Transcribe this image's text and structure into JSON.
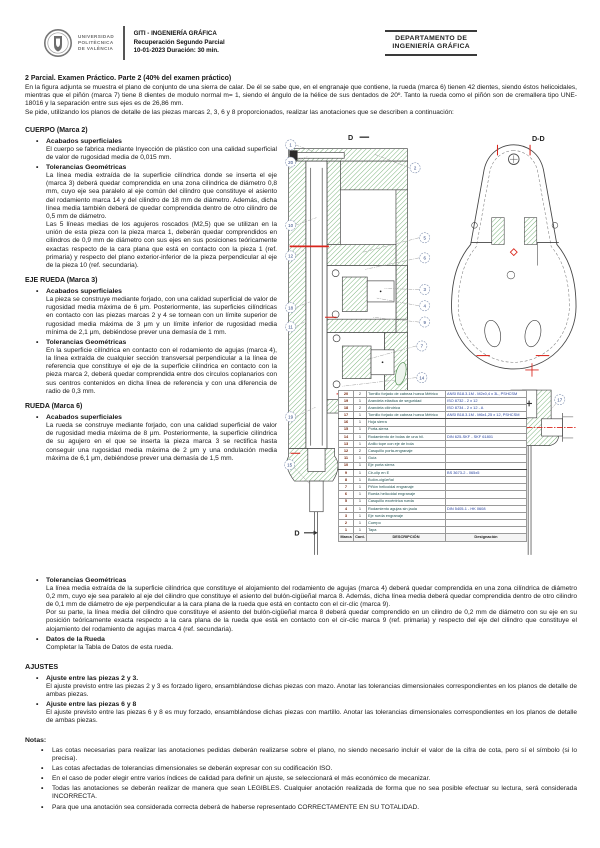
{
  "header": {
    "university_lines": [
      "UNIVERSIDAD",
      "POLITÈCNICA",
      "DE VALÈNCIA"
    ],
    "course_line1": "GITI - INGENIERÍA GRÁFICA",
    "course_line2": "Recuperación Segundo Parcial",
    "course_line3": "10-01-2023   Duración: 30 min.",
    "department_line1": "DEPARTAMENTO DE",
    "department_line2": "INGENIERÍA GRÁFICA"
  },
  "title": "2 Parcial. Examen Práctico. Parte 2 (40% del examen práctico)",
  "intro_p1": "En la figura adjunta se muestra el plano de conjunto de una sierra de calar. De él se sabe que, en el engranaje que contiene, la rueda (marca 6) tienen 42 dientes, siendo éstos helicoidales, mientras que el piñón (marca 7) tiene 8 dientes de modulo normal m= 1, siendo el ángulo de la hélice de sus dentados de 20º. Tanto la rueda como el piñón son de cremallera tipo UNE-18016 y la separación entre sus ejes es de 26,86 mm.",
  "intro_p2": "Se pide, utilizando los planos de detalle de las piezas marcas 2, 3, 6 y 8 proporcionados, realizar las anotaciones que se describen a continuación:",
  "sections": {
    "cuerpo": {
      "heading": "CUERPO (Marca 2)",
      "b1": {
        "title": "Acabados superficiales",
        "body": "El cuerpo se fabrica mediante Inyección de plástico con una calidad superficial de valor de rugosidad media de 0,015 mm."
      },
      "b2": {
        "title": "Tolerancias Geométricas",
        "body": "La línea media extraída de la superficie cilíndrica donde se inserta el eje (marca 3) deberá quedar comprendida en una zona cilíndrica de diámetro 0,8 mm, cuyo eje sea paralelo al eje común del cilindro que constituye el asiento del rodamiento marca 14 y del cilindro de 18 mm de diámetro. Además, dicha línea media también deberá de quedar comprendida dentro de otro cilindro de 0,5 mm de diámetro.",
        "body2": "Las 5 líneas medias de los agujeros roscados (M2,5) que se utilizan en la unión de esta pieza con la pieza marca 1, deberán quedar comprendidos en cilindros de 0,9 mm de diámetro con sus ejes en sus posiciones teóricamente exactas respecto de la cara plana que está en contacto con la pieza 1 (ref. primaria) y respecto del plano exterior-inferior de la pieza perpendicular al eje de la pieza 10 (ref. secundaria)."
      }
    },
    "eje": {
      "heading": "EJE RUEDA (Marca 3)",
      "b1": {
        "title": "Acabados superficiales",
        "body": "La pieza se construye mediante forjado, con una calidad superficial de valor de rugosidad media máxima de 6 μm. Posteriormente, las superficies cilíndricas en contacto con las piezas marcas 2 y 4 se tornean con un límite superior de rugosidad media máxima de 3 μm y un límite inferior de rugosidad media mínima de 2,1 μm, debiéndose prever una demasía de 1 mm."
      },
      "b2": {
        "title": "Tolerancias Geométricas",
        "body": "En la superficie cilíndrica en contacto con el rodamiento de agujas (marca 4), la línea extraída de cualquier sección transversal perpendicular a la línea de referencia que constituye el eje de la superficie cilíndrica en contacto con la pieza marca 2, deberá quedar comprendida entre dos círculos coplanarios con sus centros contenidos en dicha línea de referencia y con una diferencia de radio de 0,3 mm."
      }
    },
    "rueda": {
      "heading": "RUEDA (Marca 6)",
      "b1": {
        "title": "Acabados superficiales",
        "body": "La rueda se construye mediante forjado, con una calidad superficial de valor de rugosidad media máxima de 8 μm. Posteriormente, la superficie cilíndrica de su agujero en el que se inserta la pieza marca 3 se rectifica hasta conseguir una rugosidad media máxima de 2 μm y una ondulación media máxima de 6,1 μm, debiéndose prever una demasía de 1,5 mm."
      },
      "b2": {
        "title": "Tolerancias Geométricas",
        "body": "La línea media extraída de la superficie cilíndrica que constituye el alojamiento del rodamiento de agujas (marca 4) deberá quedar comprendida en una zona cilíndrica de diámetro 0,2 mm, cuyo eje sea paralelo al eje del cilindro que constituye el asiento del bulón-cigüeñal marca 8. Además, dicha línea media deberá quedar comprendida dentro de otro cilindro de 0,1 mm de diámetro de eje perpendicular a la cara plana de la rueda que está en contacto con el cir-clic (marca 9).",
        "body2": "Por su parte, la línea media del cilindro que constituye el asiento del bulón-cigüeñal marca 8 deberá quedar comprendido en un cilindro de 0,2 mm de diámetro con su eje en su posición teóricamente exacta respecto a la cara plana de la rueda que está en contacto con el cir-clic marca 9 (ref. primaria) y respecto del eje del cilindro que constituye el alojamiento del rodamiento de agujas marca 4 (ref. secundaria)."
      },
      "b3": {
        "title": "Datos de la Rueda",
        "body": "Completar la Tabla de Datos de esta rueda."
      }
    }
  },
  "ajustes": {
    "heading": "AJUSTES",
    "a1": {
      "title": "Ajuste entre las piezas 2 y 3.",
      "body": "El ajuste previsto entre las piezas 2 y 3 es forzado ligero, ensamblándose dichas piezas con mazo. Anotar las tolerancias dimensionales correspondientes en los planos de detalle de ambas piezas."
    },
    "a2": {
      "title": "Ajuste entre las piezas 6 y 8",
      "body": "El ajuste previsto entre las piezas 6 y 8 es muy forzado, ensamblándose dichas piezas con martillo. Anotar las tolerancias dimensionales correspondientes en los planos de detalle de ambas piezas."
    }
  },
  "notas": {
    "heading": "Notas:",
    "n1": "Las cotas necesarias para realizar las anotaciones pedidas deberán realizarse sobre el plano, no siendo necesario incluir el valor de la cifra de cota, pero sí el símbolo (si lo precisa).",
    "n2": "Las cotas afectadas de tolerancias dimensionales se deberán expresar con su codificación ISO.",
    "n3": "En el caso de poder elegir entre varios índices de calidad para definir un ajuste, se seleccionará el más económico de mecanizar.",
    "n4": "Todas las anotaciones se deberán realizar de manera que sean LEGIBLES. Cualquier anotación realizada de forma que no sea posible efectuar su lectura, será considerada INCORRECTA.",
    "n5": "Para que una anotación sea considerada correcta deberá de haberse representado CORRECTAMENTE EN SU TOTALIDAD."
  },
  "figure": {
    "labels": {
      "section_top": "D",
      "section_bottom": "D",
      "dd": "D-D"
    },
    "balloons_left": [
      "1",
      "20",
      "10",
      "12",
      "18",
      "11",
      "19",
      "15"
    ],
    "balloons_right": [
      "2",
      "5",
      "6",
      "3",
      "4",
      "9",
      "7",
      "14"
    ],
    "detail_balloon": "17",
    "colors": {
      "hatch": "#69a869",
      "accent_red": "#d9261c",
      "balloon": "#7f8fae",
      "designacion_blue": "#2743a0"
    },
    "parts_table": {
      "headers": [
        "Marca",
        "Cant.",
        "DESCRIPCIÓN",
        "Designación"
      ],
      "rows": [
        {
          "marca": "20",
          "cant": "2",
          "desc": "Tornillo forjado de cabeza hueca Métrico",
          "desig": "ANSI B18.3.1M - M2x0,4 x 3L, PSHCSM"
        },
        {
          "marca": "19",
          "cant": "1",
          "desc": "Arandela elástica de seguridad",
          "desig": "ISO 8732 - 2 x 12"
        },
        {
          "marca": "18",
          "cant": "2",
          "desc": "Arandela cilíndrica",
          "desig": "ISO 8734 - 2 x 12 - A"
        },
        {
          "marca": "17",
          "cant": "1",
          "desc": "Tornillo forjado de cabeza hueca Métrico",
          "desig": "ANSI B18.3.1M - M6x1,25 x 12, PSHCSM"
        },
        {
          "marca": "16",
          "cant": "1",
          "desc": "Hoja sierra",
          "desig": ""
        },
        {
          "marca": "15",
          "cant": "1",
          "desc": "Porta-sierra",
          "desig": ""
        },
        {
          "marca": "14",
          "cant": "1",
          "desc": "Rodamiento de bolas de una hil.",
          "desig": "DIN 625-SKF - SKF 61801"
        },
        {
          "marca": "13",
          "cant": "1",
          "desc": "Anillo tope con eje de bola",
          "desig": ""
        },
        {
          "marca": "12",
          "cant": "2",
          "desc": "Casquillo porta-engranaje",
          "desig": ""
        },
        {
          "marca": "11",
          "cant": "1",
          "desc": "Guía",
          "desig": ""
        },
        {
          "marca": "10",
          "cant": "1",
          "desc": "Eje porta sierra",
          "desig": ""
        },
        {
          "marca": "9",
          "cant": "1",
          "desc": "Cir-clip en E",
          "desig": "BS 3673-2 - 065x5"
        },
        {
          "marca": "8",
          "cant": "1",
          "desc": "Bulón-cigüeñal",
          "desig": ""
        },
        {
          "marca": "7",
          "cant": "1",
          "desc": "Piñón helicoidal engranaje",
          "desig": ""
        },
        {
          "marca": "6",
          "cant": "1",
          "desc": "Rueda helicoidal engranaje",
          "desig": ""
        },
        {
          "marca": "5",
          "cant": "1",
          "desc": "Casquillo excéntrica rueda",
          "desig": ""
        },
        {
          "marca": "4",
          "cant": "1",
          "desc": "Rodamiento agujas sin jaula",
          "desig": "DIN 5405-1 - HK 0608"
        },
        {
          "marca": "3",
          "cant": "1",
          "desc": "Eje rueda engranaje",
          "desig": ""
        },
        {
          "marca": "2",
          "cant": "1",
          "desc": "Cuerpo",
          "desig": ""
        },
        {
          "marca": "1",
          "cant": "1",
          "desc": "Tapa",
          "desig": ""
        }
      ]
    }
  }
}
